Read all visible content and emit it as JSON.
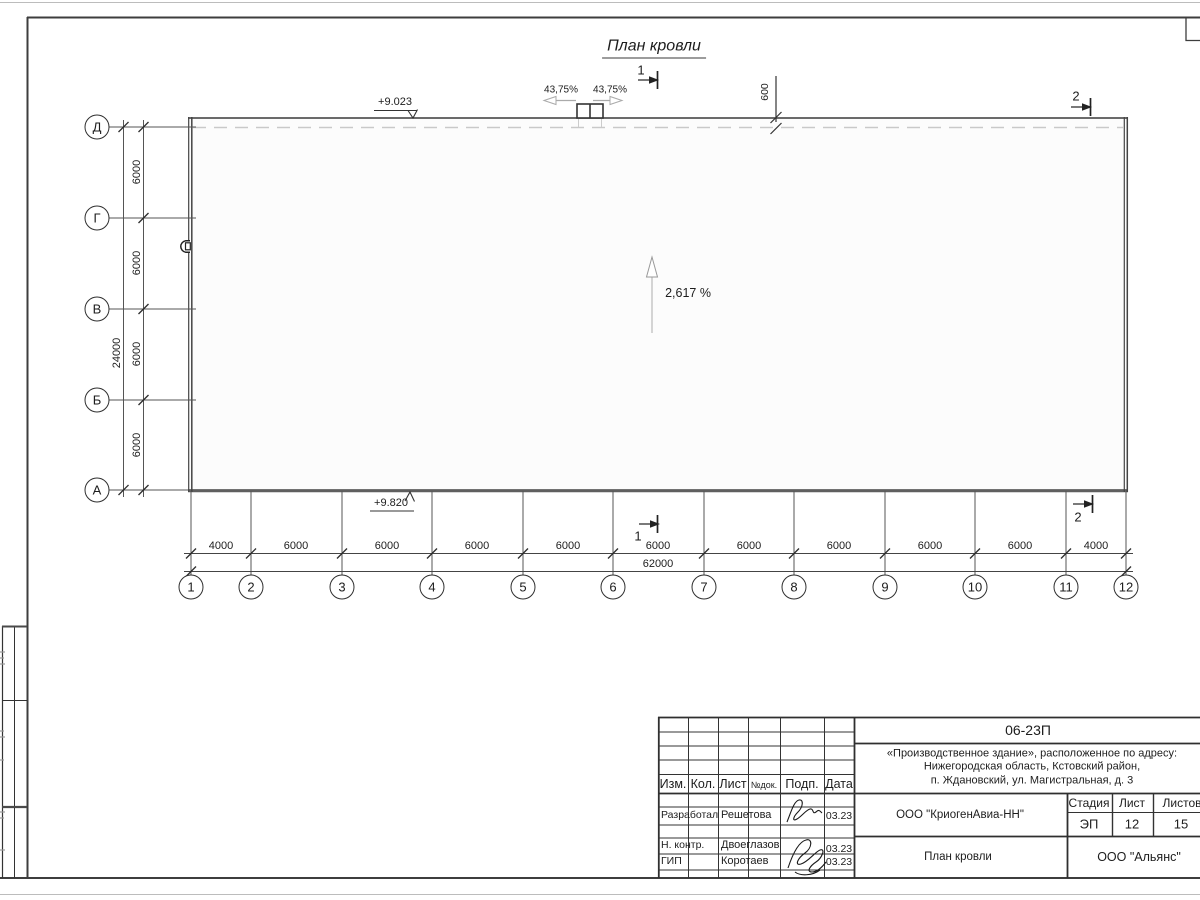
{
  "sheet": {
    "title": "План кровли",
    "annotations": {
      "elevation_top": "+9.023",
      "elevation_bottom": "+9.820",
      "slope": "2,617 %",
      "vent_slope_left": "43,75%",
      "vent_slope_right": "43,75%",
      "parapet_dim": "600",
      "section1": "1",
      "section2": "2"
    },
    "grid": {
      "row_axes": [
        "Д",
        "Г",
        "В",
        "Б",
        "А"
      ],
      "row_dims": [
        "6000",
        "6000",
        "6000",
        "6000"
      ],
      "row_total": "24000",
      "col_axes": [
        "1",
        "2",
        "3",
        "4",
        "5",
        "6",
        "7",
        "8",
        "9",
        "10",
        "11",
        "12"
      ],
      "col_dims": [
        "4000",
        "6000",
        "6000",
        "6000",
        "6000",
        "6000",
        "6000",
        "6000",
        "6000",
        "6000",
        "4000"
      ],
      "col_total": "62000"
    }
  },
  "title_block": {
    "doc_number": "06-23П",
    "project_address_line1": "«Производственное здание», расположенное по адресу:",
    "project_address_line2": "Нижегородская область, Кстовский район,",
    "project_address_line3": "п. Ждановский, ул. Магистральная, д. 3",
    "client": "ООО \"КриогенАвиа-НН\"",
    "drawing_name": "План кровли",
    "company": "ООО \"Альянс\"",
    "stage_label": "Стадия",
    "sheet_label": "Лист",
    "sheets_label": "Листов",
    "stage_value": "ЭП",
    "sheet_value": "12",
    "sheets_value": "15",
    "columns": [
      "Изм.",
      "Кол.",
      "Лист",
      "№док.",
      "Подп.",
      "Дата"
    ],
    "signers": [
      {
        "role": "Разработал",
        "name": "Решетова",
        "date": "03.23"
      },
      {
        "role": "Н. контр.",
        "name": "Двоеглазов",
        "date": "03.23"
      },
      {
        "role": "ГИП",
        "name": "Коротаев",
        "date": "03.23"
      }
    ]
  }
}
